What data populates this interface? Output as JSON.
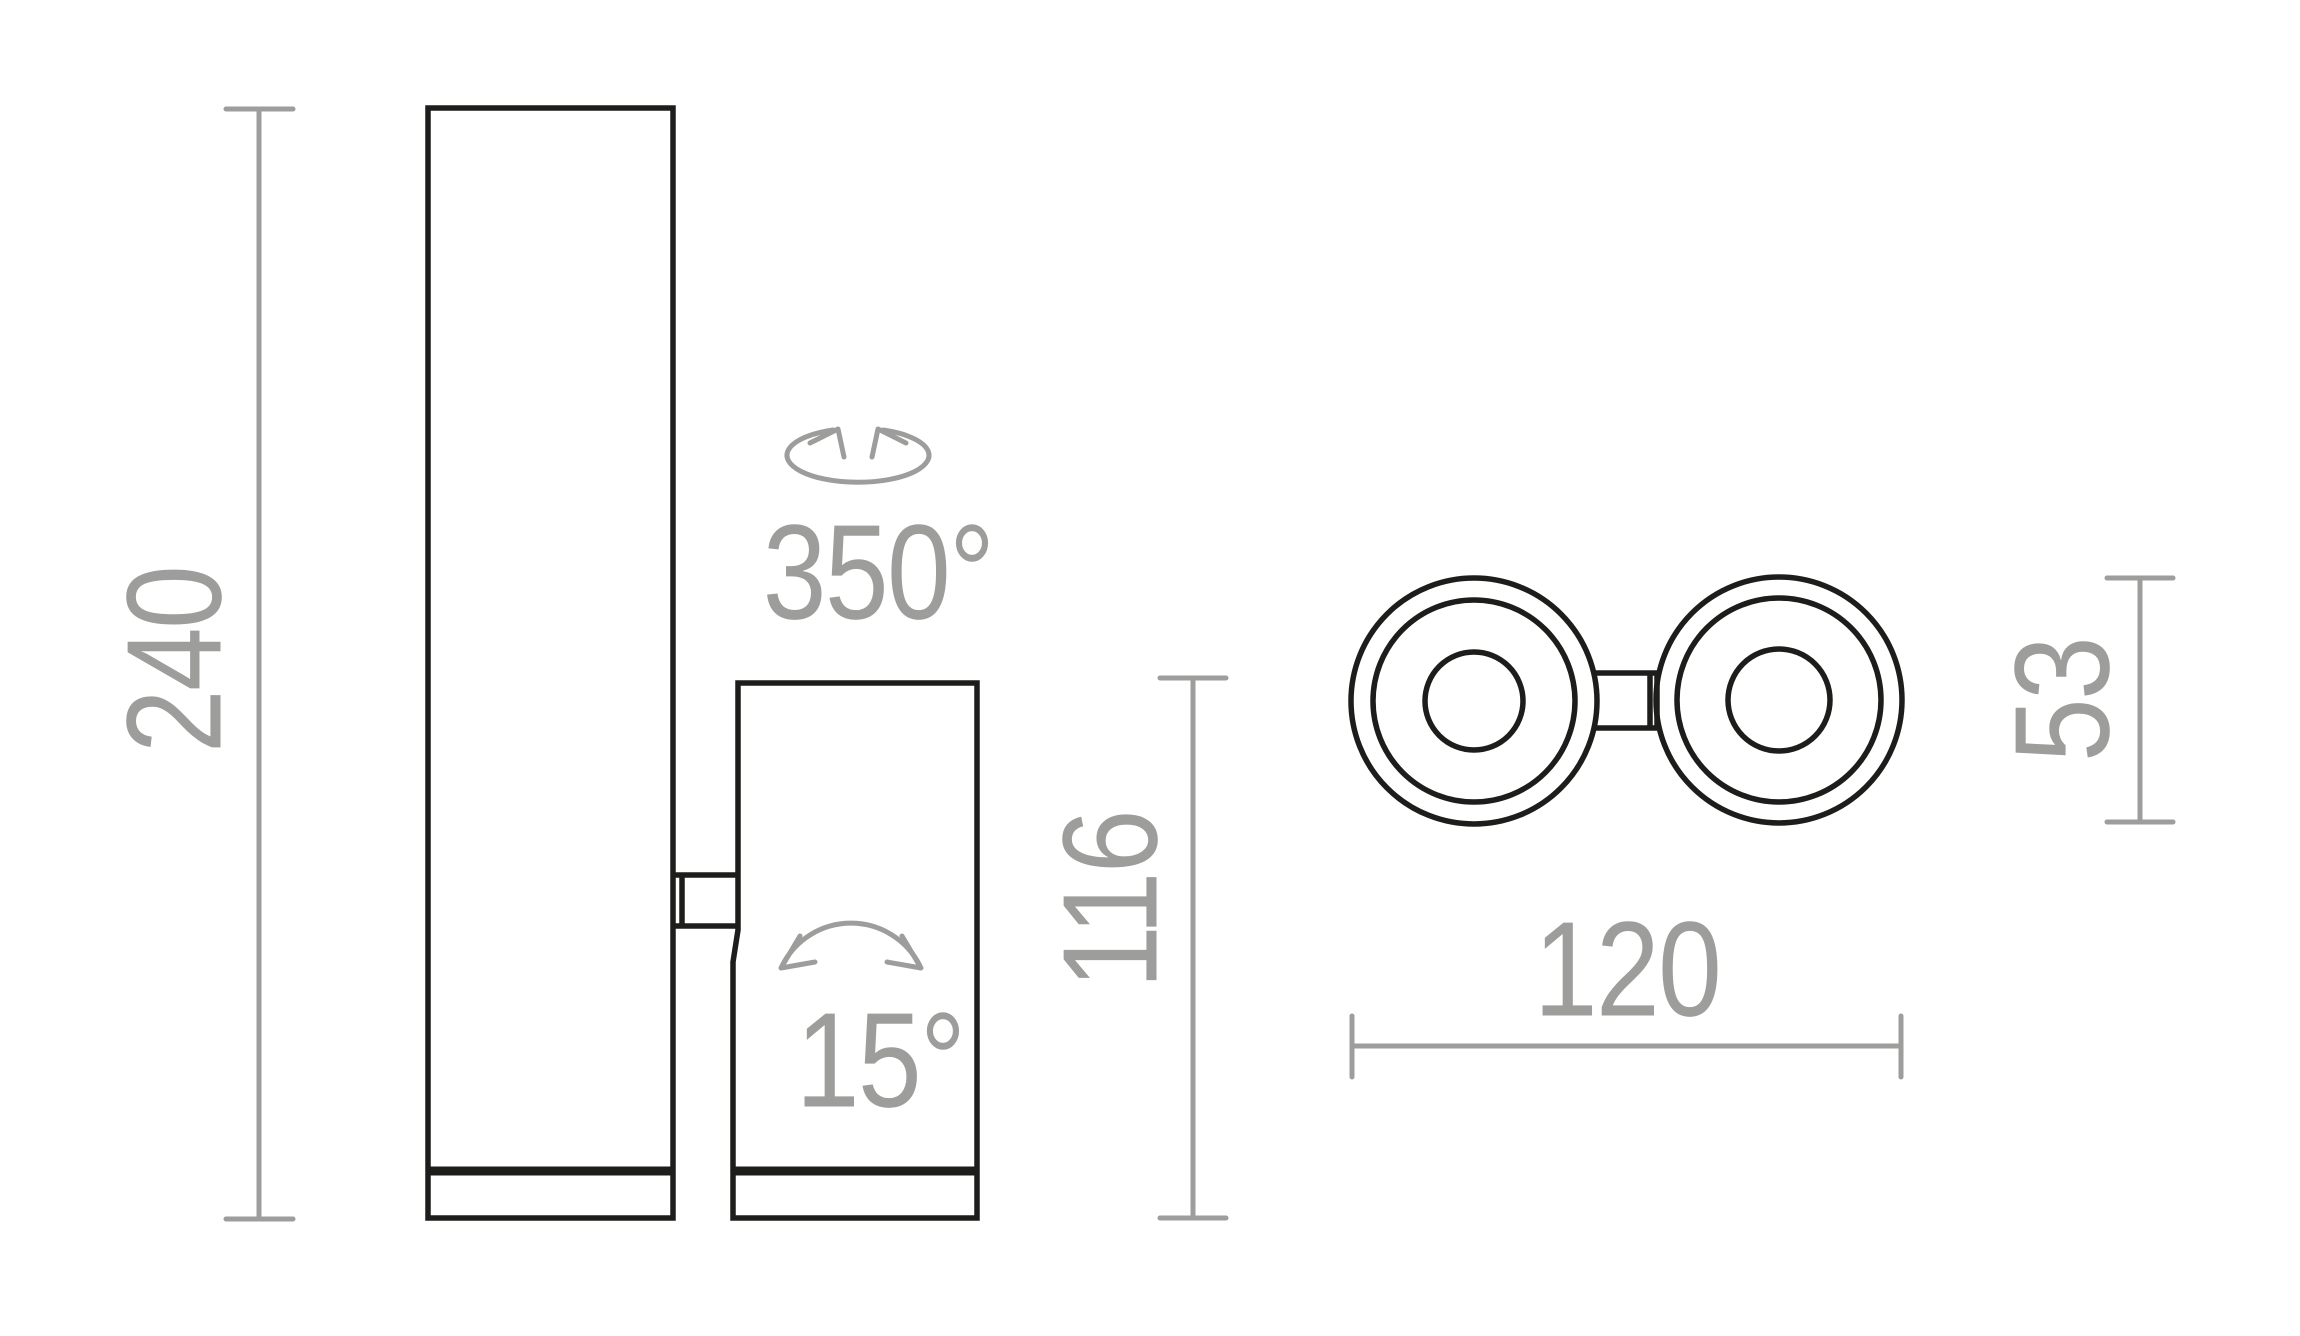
{
  "drawing_title": "dual-spot-light-dimension-drawing",
  "colors": {
    "outline": "#1d1d1b",
    "dimension": "#9d9d9c",
    "background": "#ffffff"
  },
  "side_view": {
    "height_label": "240",
    "head_length_label": "116",
    "rotation_label": "350°",
    "tilt_label": "15°",
    "rotation_icon": "rotation-arrows-icon",
    "tilt_icon": "tilt-arc-icon"
  },
  "top_view": {
    "width_label": "120",
    "diameter_label": "53"
  }
}
